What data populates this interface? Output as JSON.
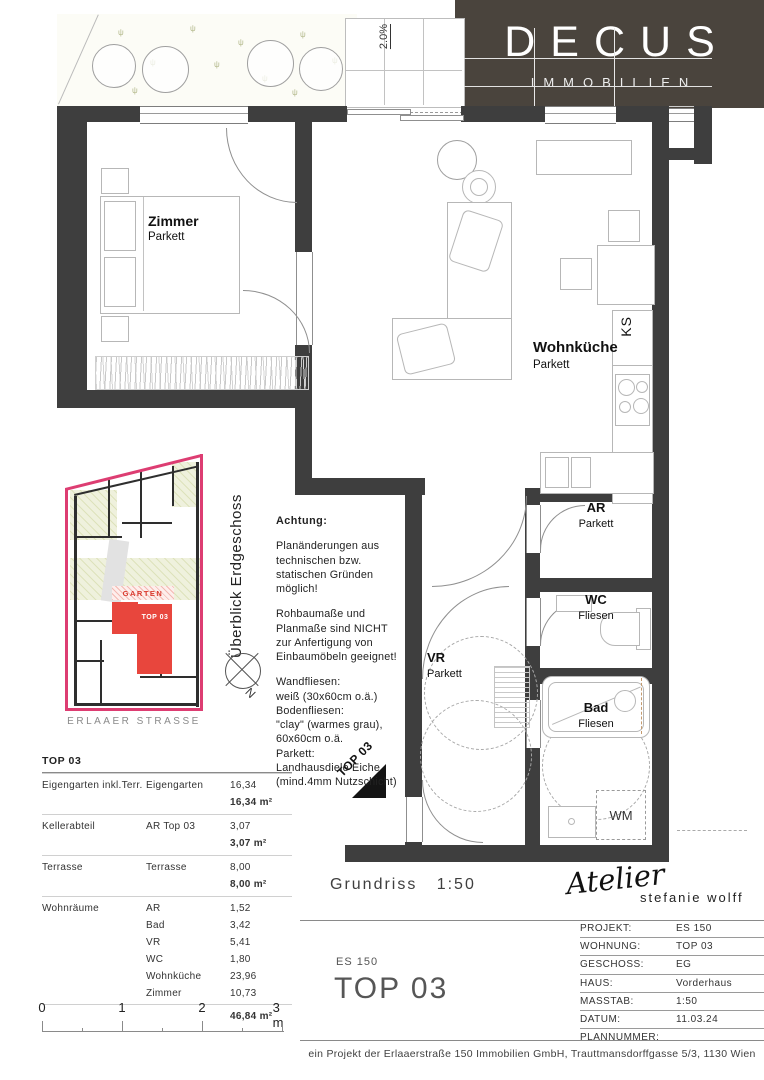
{
  "logo": {
    "brand": "DECUS",
    "subtitle": "IMMOBILIEN",
    "bg_color": "#4a443d"
  },
  "plan": {
    "slope_label": "2.0%",
    "entry_marker": "TOP 03",
    "rooms": {
      "zimmer": {
        "name": "Zimmer",
        "floor": "Parkett"
      },
      "wohnkueche": {
        "name": "Wohnküche",
        "floor": "Parkett"
      },
      "ar": {
        "name": "AR",
        "floor": "Parkett"
      },
      "wc": {
        "name": "WC",
        "floor": "Fliesen"
      },
      "vr": {
        "name": "VR",
        "floor": "Parkett"
      },
      "bad": {
        "name": "Bad",
        "floor": "Fliesen"
      }
    },
    "appliances": {
      "fridge": "KS",
      "washer": "WM"
    }
  },
  "overview": {
    "title": "Überblick Erdgeschoss",
    "garden_label": "GARTEN",
    "unit_label": "TOP 03",
    "street": "ERLAAER STRASSE",
    "compass_n": "N",
    "boundary_color": "#dd3d72",
    "unit_color": "#e8463d"
  },
  "notes": {
    "heading": "Achtung:",
    "para1": "Planänderungen aus\ntechnischen bzw.\nstatischen Gründen\nmöglich!",
    "para2": "Rohbaumaße und\nPlanmaße sind NICHT\nzur Anfertigung von\nEinbaumöbeln geeignet!",
    "para3": "Wandfliesen:\nweiß (30x60cm o.ä.)\nBodenfliesen:\n\"clay\" (warmes grau),\n60x60cm o.ä.\nParkett:\nLandhausdiele Eiche\n(mind.4mm Nutzschicht)"
  },
  "area_table": {
    "title": "TOP 03",
    "groups": [
      {
        "category": "Eigengarten inkl.Terr.",
        "rows": [
          [
            "Eigengarten",
            "16,34"
          ]
        ],
        "subtotal": "16,34 m²"
      },
      {
        "category": "Kellerabteil",
        "rows": [
          [
            "AR Top 03",
            "3,07"
          ]
        ],
        "subtotal": "3,07 m²"
      },
      {
        "category": "Terrasse",
        "rows": [
          [
            "Terrasse",
            "8,00"
          ]
        ],
        "subtotal": "8,00 m²"
      },
      {
        "category": "Wohnräume",
        "rows": [
          [
            "AR",
            "1,52"
          ],
          [
            "Bad",
            "3,42"
          ],
          [
            "VR",
            "5,41"
          ],
          [
            "WC",
            "1,80"
          ],
          [
            "Wohnküche",
            "23,96"
          ],
          [
            "Zimmer",
            "10,73"
          ]
        ],
        "subtotal": "46,84 m²"
      }
    ]
  },
  "scalebar": {
    "labels": [
      "0",
      "1",
      "2",
      "3 m"
    ]
  },
  "titleblock": {
    "drawing": "Grundriss",
    "scale": "1:50",
    "studio_script": "Atelier",
    "studio_name": "stefanie wolff",
    "project_code": "ES 150",
    "unit_title": "TOP 03",
    "fields": [
      {
        "label": "PROJEKT:",
        "value": "ES 150"
      },
      {
        "label": "WOHNUNG:",
        "value": "TOP 03"
      },
      {
        "label": "GESCHOSS:",
        "value": "EG"
      },
      {
        "label": "HAUS:",
        "value": "Vorderhaus"
      },
      {
        "label": "MASSTAB:",
        "value": "1:50"
      },
      {
        "label": "DATUM:",
        "value": "11.03.24"
      },
      {
        "label": "PLANNUMMER:",
        "value": ""
      }
    ],
    "footer": "ein Projekt der Erlaaerstraße 150 Immobilien GmbH, Trauttmansdorffgasse 5/3, 1130 Wien"
  }
}
